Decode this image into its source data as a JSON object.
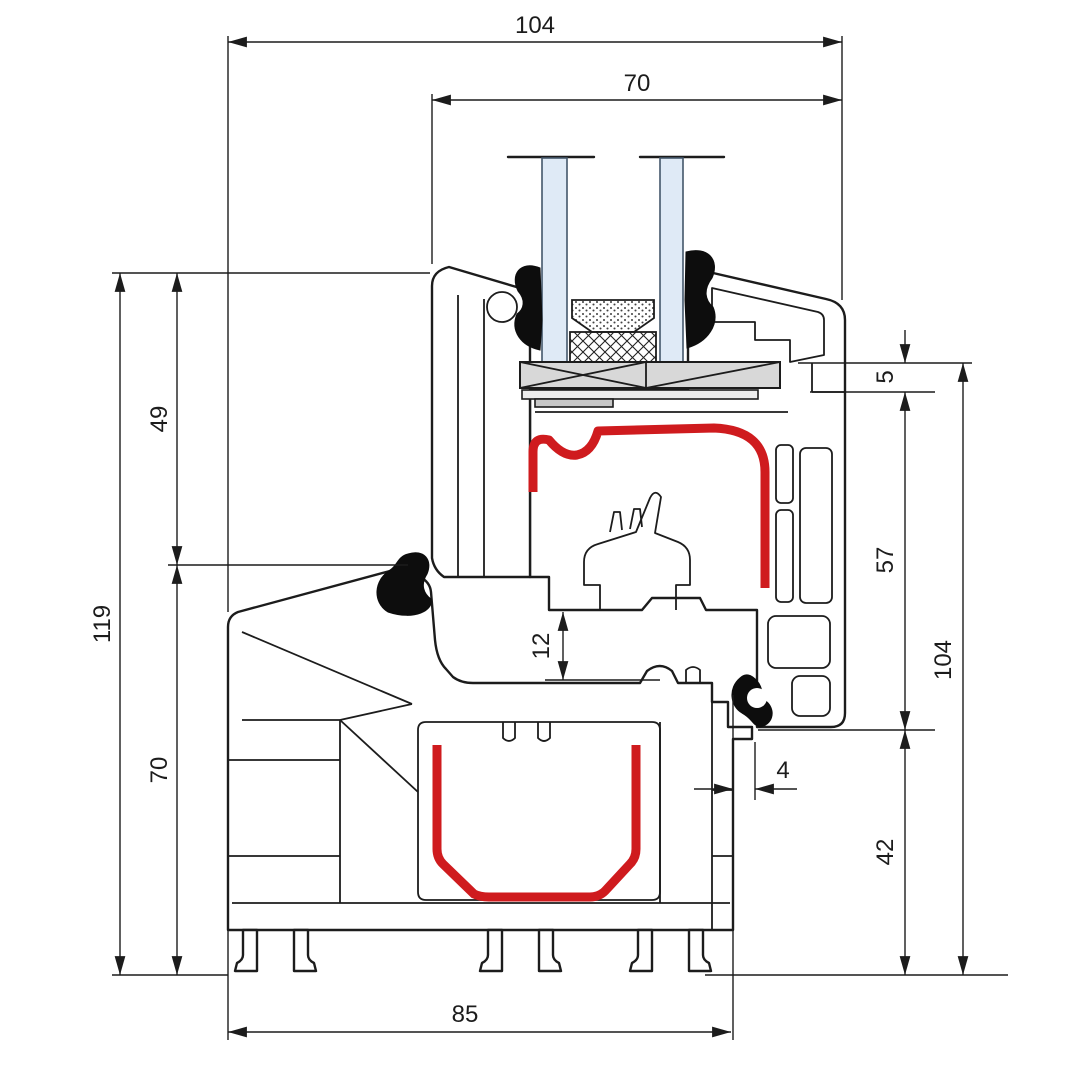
{
  "drawing": {
    "kind": "window-profile-cross-section",
    "colors": {
      "line": "#1c1c1c",
      "seal_red": "#cf1b1e",
      "glass_blue": "#dfeaf6",
      "block_gray": "#d8d8d8",
      "background": "#ffffff"
    },
    "dimensions": {
      "top_overall_width": "104",
      "top_sash_width": "70",
      "left_total_height": "119",
      "left_upper_height": "49",
      "left_lower_height": "70",
      "right_lip": "5",
      "right_sash_height": "57",
      "right_total_height": "104",
      "right_frame_height": "42",
      "overlap_clearance": "4",
      "rebate_gap": "12",
      "bottom_frame_width": "85"
    }
  }
}
